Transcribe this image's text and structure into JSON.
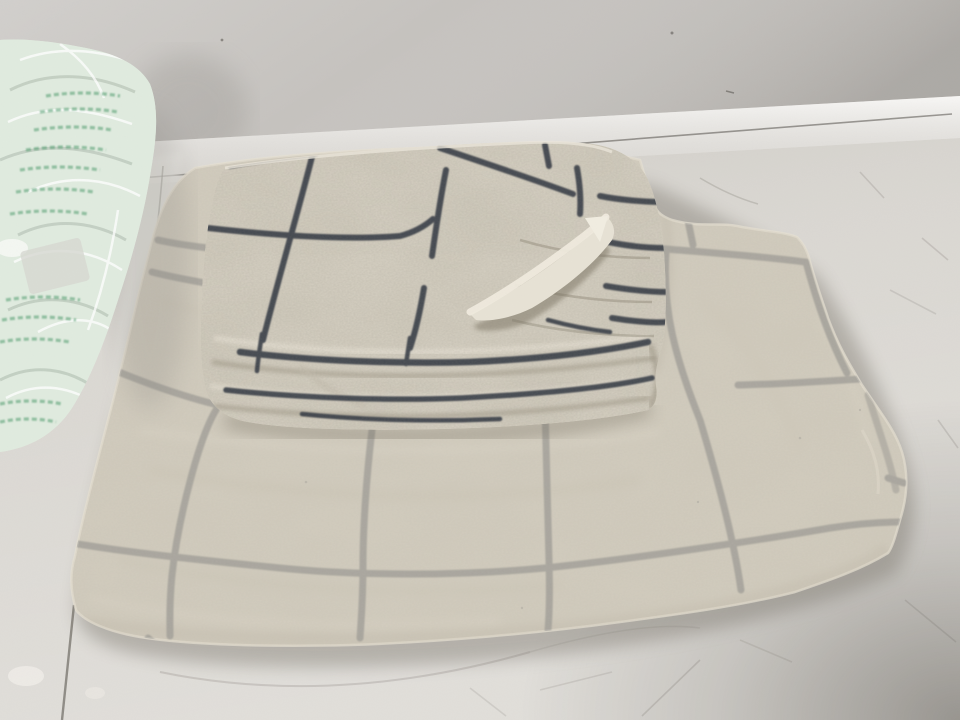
{
  "meta": {
    "type": "photograph",
    "subject": "Folded linen bedding set with navy windowpane check pattern, photographed on a white table against a grey wall"
  },
  "scene": {
    "background": "grey wall above a white table edge strip; pale scratched laminate table surface",
    "objects": [
      {
        "name": "plastic-bag",
        "desc": "crumpled transparent packaging bag with green printed text, upper left"
      },
      {
        "name": "pillowcase-stack",
        "desc": "smaller folded check pillowcase with a flipped corner showing plain underside, lying on top"
      },
      {
        "name": "large-folded-sheet",
        "desc": "large folded flat sheet with wide navy windowpane grid underneath"
      },
      {
        "name": "table-surface",
        "desc": "white table with faint circular scratch marks and chipped paint, shadow in lower right corner"
      }
    ]
  },
  "colors": {
    "wall": "#c6c3bf",
    "wall_shade": "#a9a6a1",
    "table_edge": "#f0eeea",
    "edge_line": "#5f5c56",
    "table": "#d7d4ce",
    "table_shadow": "#6f6a60",
    "fabric_base": "#d3cdbf",
    "fabric_light": "#d8d2c4",
    "fabric_shadow": "#b2ab9b",
    "fabric_underside": "#e7e2d5",
    "grid_line": "#2f3540",
    "plastic_film": "#e0ebdf",
    "plastic_print": "#4f9b6d",
    "scratch": "#76726b"
  }
}
